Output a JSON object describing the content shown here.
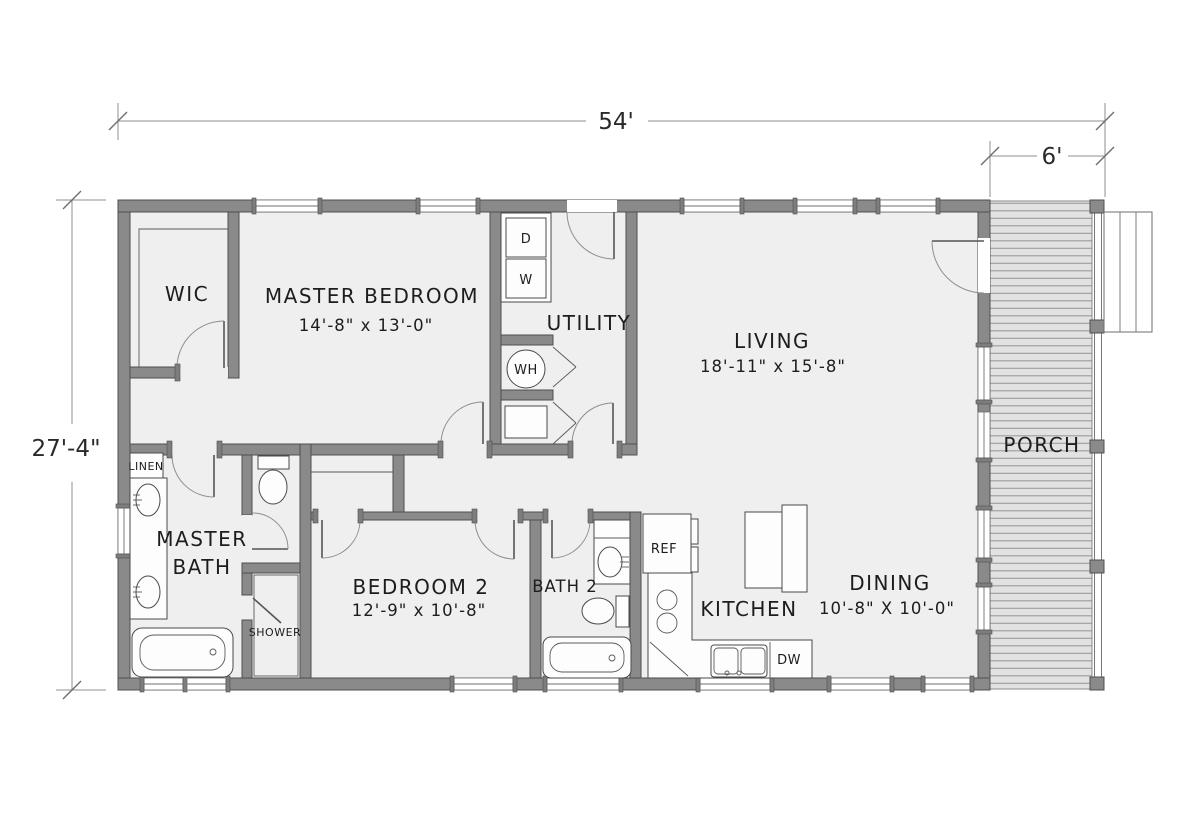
{
  "plan": {
    "title": "single-story house floor plan",
    "dimensions": {
      "overall_width": "54'",
      "porch_width": "6'",
      "overall_depth": "27'-4\""
    },
    "rooms": {
      "wic": {
        "label": "WIC"
      },
      "master_bedroom": {
        "label": "MASTER BEDROOM",
        "dims": "14'-8\" x 13'-0\""
      },
      "utility": {
        "label": "UTILITY"
      },
      "living": {
        "label": "LIVING",
        "dims": "18'-11\" x 15'-8\""
      },
      "master_bath": {
        "label_line1": "MASTER",
        "label_line2": "BATH"
      },
      "linen": {
        "label": "LINEN"
      },
      "shower": {
        "label": "SHOWER"
      },
      "bedroom2": {
        "label": "BEDROOM 2",
        "dims": "12'-9\" x 10'-8\""
      },
      "bath2": {
        "label": "BATH 2"
      },
      "kitchen": {
        "label": "KITCHEN"
      },
      "dining": {
        "label": "DINING",
        "dims": "10'-8\" X 10'-0\""
      },
      "porch": {
        "label": "PORCH"
      }
    },
    "appliances": {
      "dryer": "D",
      "washer": "W",
      "water_heater": "WH",
      "refrigerator": "REF",
      "dishwasher": "DW"
    },
    "colors": {
      "wall": "#8a8a8a",
      "wall_outline": "#4f4f4f",
      "floor": "#efefef",
      "porch_floor": "#e2e2e2",
      "deck_line": "#9b9b9b",
      "dim_line": "#8f8f8f",
      "text": "#1d1d1d"
    }
  }
}
